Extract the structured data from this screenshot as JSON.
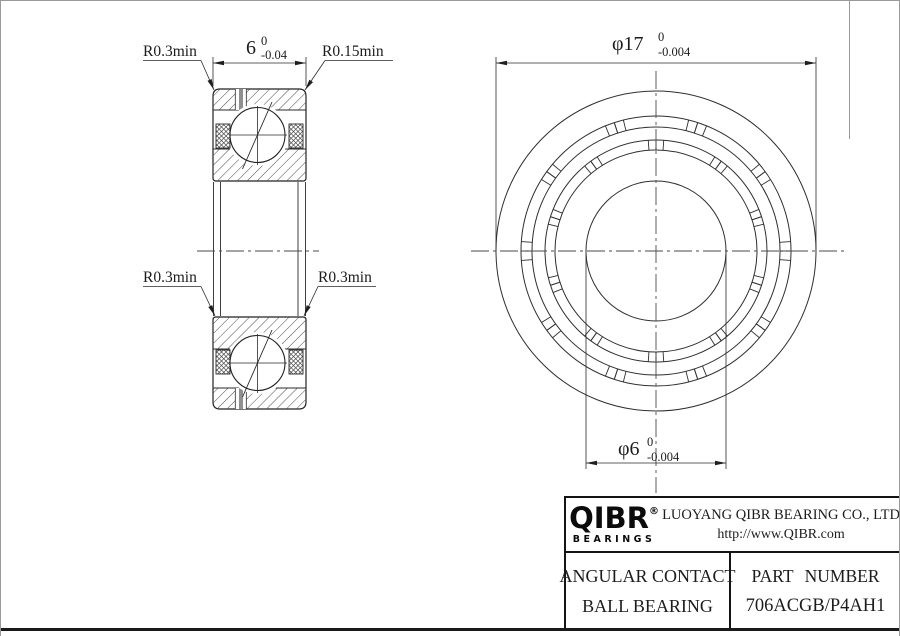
{
  "section_view": {
    "labels": {
      "radius_top_left": "R0.3min",
      "radius_top_right": "R0.15min",
      "radius_mid_left": "R0.3min",
      "radius_mid_right": "R0.3min"
    },
    "width_dim": {
      "nominal": "6",
      "tol_upper": "0",
      "tol_lower": "-0.04"
    }
  },
  "front_view": {
    "od_dim": {
      "prefix": "φ",
      "nominal": "17",
      "tol_upper": "0",
      "tol_lower": "-0.004"
    },
    "bore_dim": {
      "prefix": "φ",
      "nominal": "6",
      "tol_upper": "0",
      "tol_lower": "-0.004"
    },
    "geometry": {
      "cx": 655,
      "cy": 250,
      "circle_radii": [
        160,
        135,
        124,
        111,
        101,
        70
      ],
      "pocket_bands": [
        {
          "r_inner": 124,
          "r_outer": 135,
          "offset_deg": 90
        },
        {
          "r_inner": 101,
          "r_outer": 111,
          "offset_deg": 108
        }
      ],
      "pocket_count": 10,
      "tick_half_angles": [
        14,
        18
      ]
    }
  },
  "title_block": {
    "brand": "QIBR",
    "brand_mark": "®",
    "brand_sub": "BEARINGS",
    "company": "LUOYANG QIBR BEARING CO., LTD",
    "website": "http://www.QIBR.com",
    "product_name_line1": "ANGULAR CONTACT",
    "product_name_line2": "BALL BEARING",
    "part_number_label": "PART NUMBER",
    "part_number": "706ACGB/P4AH1"
  },
  "colors": {
    "line": "#2a2a2a",
    "hatch": "#4a4a4a",
    "heavy_border": "#141414"
  }
}
